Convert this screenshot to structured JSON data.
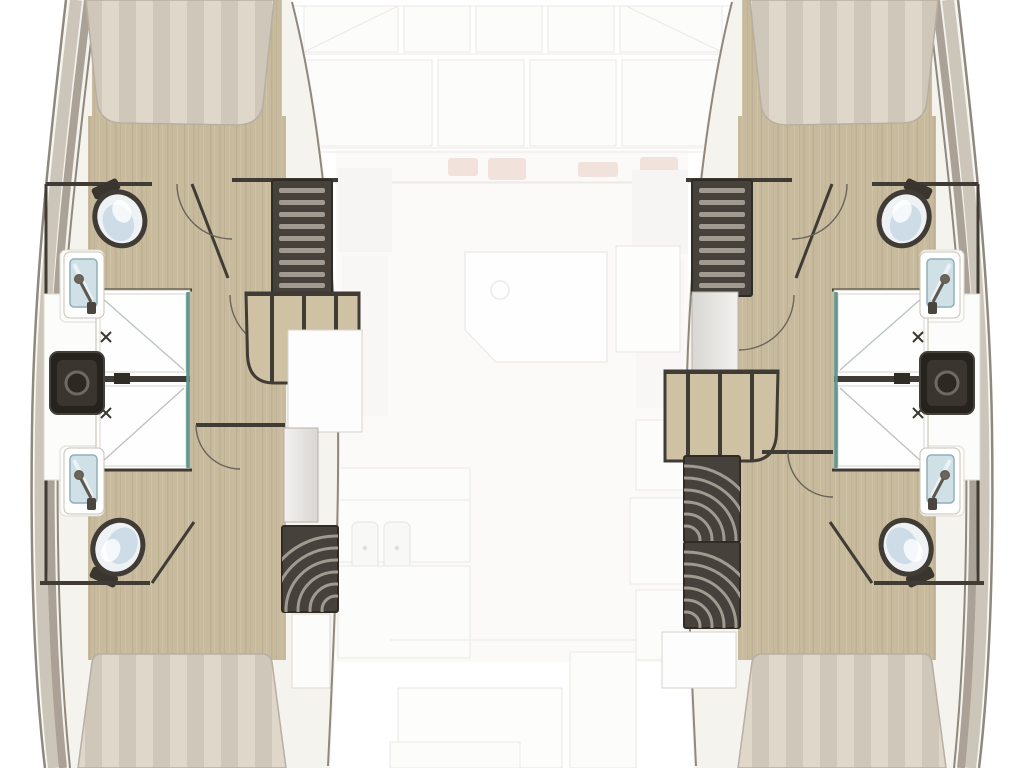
{
  "title": "Catamaran yacht interior deck plan - top-down floor layout",
  "view": "top-down deck plan, saloon level ghosted",
  "palette": {
    "hullFill": "#f5f3ee",
    "bandLight": "#ccc5b9",
    "bandMid": "#aaa296",
    "bandDark": "#8f887d",
    "bandLine": "#8f887d",
    "wood": "#c7ba9d",
    "woodStreakD": "#a99c7f",
    "woodStreakL": "#d8cdb2",
    "stripeA": "#ded7ca",
    "stripeB": "#cfc7b9",
    "bedEdge": "#b7afa1",
    "wall": "#403b34",
    "doorArc": "#6a645b",
    "panelDark": "#46413a",
    "tread": "#a09a90",
    "stepBeige": "#cfc1a4",
    "glassTeal": "#63988f",
    "glassBlue": "#cfe0e6",
    "porcelain": "#eef2f5",
    "porcelainShade": "#c9d9e4",
    "darkUnit": "#26231f",
    "darkUnitInner": "#3a362f",
    "ghostLine": "#ddd8d1",
    "cushion": "#dcb5a4"
  },
  "vessel": {
    "type": "catamaran",
    "hulls": [
      {
        "id": "port-hull",
        "side": "left",
        "fixtures": [
          "forward-berth-bed",
          "forward-toilet",
          "forward-shower-fixture",
          "shower-stall-double",
          "sink-vanity",
          "ladder-steps",
          "companionway-steps",
          "wardrobe-panel",
          "curved-steps",
          "aft-shower-fixture",
          "aft-toilet",
          "aft-berth-bed"
        ]
      },
      {
        "id": "starboard-hull",
        "side": "right",
        "fixtures": [
          "forward-berth-bed",
          "forward-toilet",
          "forward-shower-fixture",
          "shower-stall-double",
          "sink-vanity",
          "ladder-steps",
          "companionway-steps",
          "wardrobe-panel",
          "curved-steps",
          "aft-shower-fixture",
          "aft-toilet",
          "aft-berth-bed"
        ]
      }
    ],
    "saloon": {
      "style": "ghosted / faded center section",
      "features": [
        "forward-windows",
        "forward-seating",
        "seat-cushions",
        "saloon-table",
        "side-seat",
        "galley-counter",
        "galley-double-sink",
        "aft-cockpit-bench"
      ]
    }
  }
}
